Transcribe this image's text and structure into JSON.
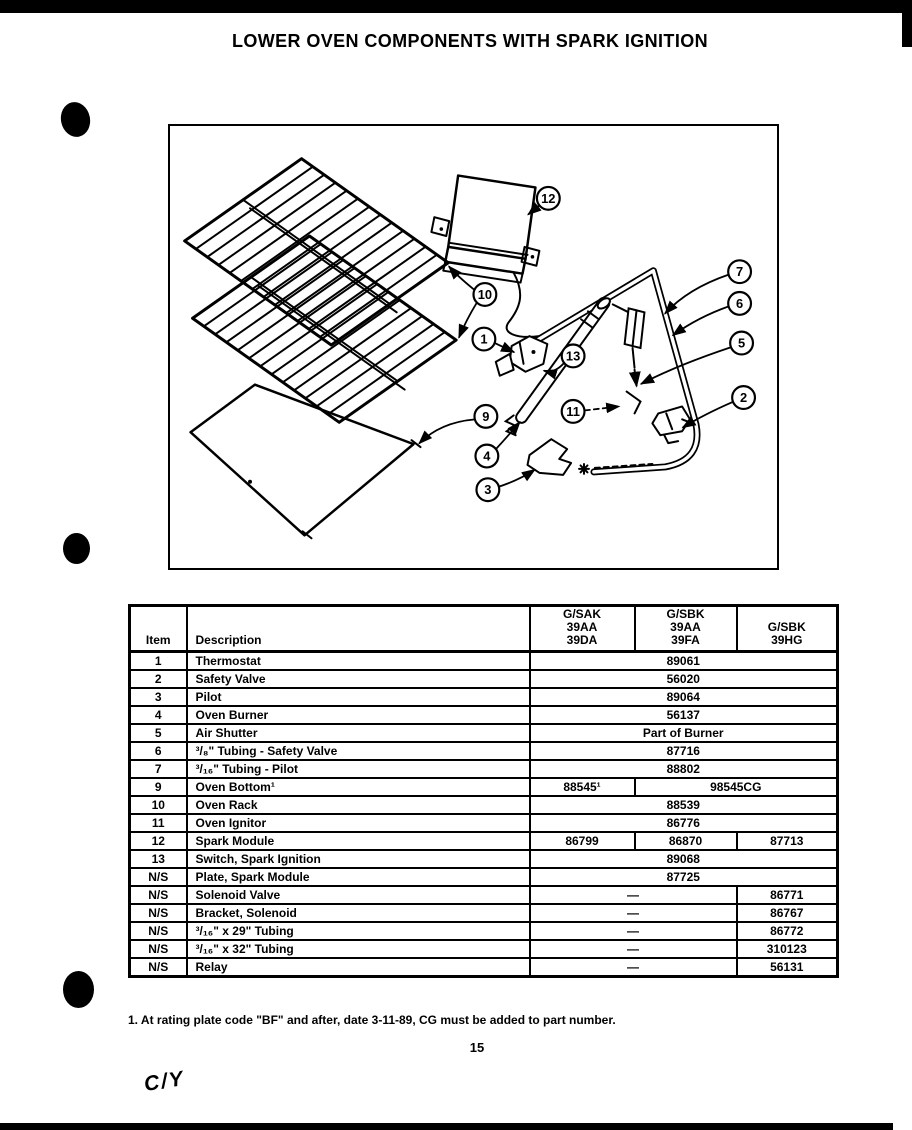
{
  "page": {
    "title": "LOWER OVEN COMPONENTS WITH SPARK IGNITION",
    "page_number": "15",
    "footnote": "1. At rating plate code \"BF\" and after, date 3-11-89, CG must be added to part number.",
    "handwritten_mark": "C/Y"
  },
  "diagram": {
    "callouts": [
      {
        "label": "12"
      },
      {
        "label": "10"
      },
      {
        "label": "7"
      },
      {
        "label": "6"
      },
      {
        "label": "5"
      },
      {
        "label": "2"
      },
      {
        "label": "1"
      },
      {
        "label": "13"
      },
      {
        "label": "9"
      },
      {
        "label": "11"
      },
      {
        "label": "4"
      },
      {
        "label": "3"
      }
    ]
  },
  "table": {
    "headers": {
      "item": "Item",
      "description": "Description",
      "models": [
        [
          "G/SAK",
          "39AA",
          "39DA"
        ],
        [
          "G/SBK",
          "39AA",
          "39FA"
        ],
        [
          "G/SBK",
          "39HG"
        ]
      ]
    },
    "rows": [
      {
        "item": "1",
        "description": "Thermostat",
        "values": [
          "89061"
        ]
      },
      {
        "item": "2",
        "description": "Safety Valve",
        "values": [
          "56020"
        ]
      },
      {
        "item": "3",
        "description": "Pilot",
        "values": [
          "89064"
        ]
      },
      {
        "item": "4",
        "description": "Oven Burner",
        "values": [
          "56137"
        ]
      },
      {
        "item": "5",
        "description": "Air Shutter",
        "values": [
          "Part of Burner"
        ]
      },
      {
        "item": "6",
        "description": "³/₈\" Tubing - Safety Valve",
        "values": [
          "87716"
        ]
      },
      {
        "item": "7",
        "description": "³/₁₆\" Tubing - Pilot",
        "values": [
          "88802"
        ]
      },
      {
        "item": "9",
        "description": "Oven Bottom¹",
        "values": [
          "88545¹",
          "98545CG"
        ]
      },
      {
        "item": "10",
        "description": "Oven Rack",
        "values": [
          "88539"
        ]
      },
      {
        "item": "11",
        "description": "Oven Ignitor",
        "values": [
          "86776"
        ]
      },
      {
        "item": "12",
        "description": "Spark Module",
        "values": [
          "86799",
          "86870",
          "87713"
        ]
      },
      {
        "item": "13",
        "description": "Switch, Spark Ignition",
        "values": [
          "89068"
        ]
      },
      {
        "item": "N/S",
        "description": "Plate, Spark Module",
        "values": [
          "87725"
        ]
      },
      {
        "item": "N/S",
        "description": "Solenoid Valve",
        "values": [
          "—",
          "86771"
        ]
      },
      {
        "item": "N/S",
        "description": "Bracket, Solenoid",
        "values": [
          "—",
          "86767"
        ]
      },
      {
        "item": "N/S",
        "description": "³/₁₆\" x 29\" Tubing",
        "values": [
          "—",
          "86772"
        ]
      },
      {
        "item": "N/S",
        "description": "³/₁₆\" x 32\" Tubing",
        "values": [
          "—",
          "310123"
        ]
      },
      {
        "item": "N/S",
        "description": "Relay",
        "values": [
          "—",
          "56131"
        ]
      }
    ]
  }
}
